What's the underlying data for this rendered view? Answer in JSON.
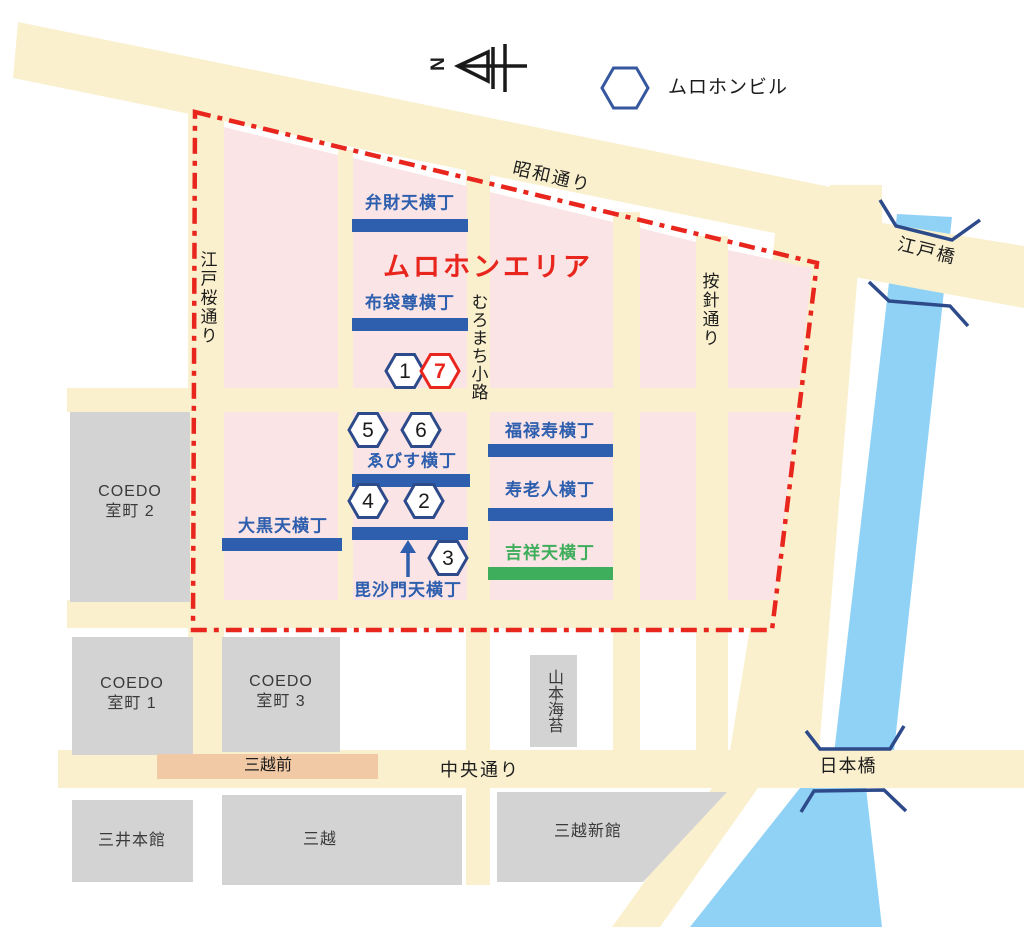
{
  "legend": {
    "building_label": "ムロホンビル"
  },
  "compass": {
    "north": "N"
  },
  "area": {
    "title": "ムロホンエリア"
  },
  "streets": {
    "showa": "昭和通り",
    "edozakura": "江戸桜通り",
    "muromachi": "むろまち小路",
    "anjin": "按針通り",
    "chuo": "中央通り",
    "nihonbashi": "日本橋",
    "edobashi": "江戸橋"
  },
  "station": {
    "mitsukoshimae": "三越前"
  },
  "yokocho": {
    "benzaiten": "弁財天横丁",
    "hotei": "布袋尊横丁",
    "fukurokuju": "福禄寿横丁",
    "jurojin": "寿老人横丁",
    "daikokuten": "大黒天横丁",
    "ebisu": "ゑびす横丁",
    "bishamonten": "毘沙門天横丁",
    "kisshoten": "吉祥天横丁"
  },
  "buildings": {
    "coedo2_l1": "COEDO",
    "coedo2_l2": "室町 2",
    "coedo1_l1": "COEDO",
    "coedo1_l2": "室町 1",
    "coedo3_l1": "COEDO",
    "coedo3_l2": "室町 3",
    "yamamoto": "山本海苔",
    "mitsui": "三井本館",
    "mitsukoshi": "三越",
    "shinkan": "三越新館"
  },
  "markers": {
    "n1": "1",
    "n2": "2",
    "n3": "3",
    "n4": "4",
    "n5": "5",
    "n6": "6",
    "n7": "7"
  },
  "colors": {
    "road": "#faf0cd",
    "block_pink": "#fbe4e6",
    "river": "#8fd2f6",
    "boundary_red": "#e8261d",
    "yokocho_blue": "#2d5fae",
    "kisshoten_green": "#3fae5c",
    "hex_navy": "#2d4a8a",
    "building_gray": "#d3d3d3",
    "station_tan": "#f2c9a5"
  }
}
